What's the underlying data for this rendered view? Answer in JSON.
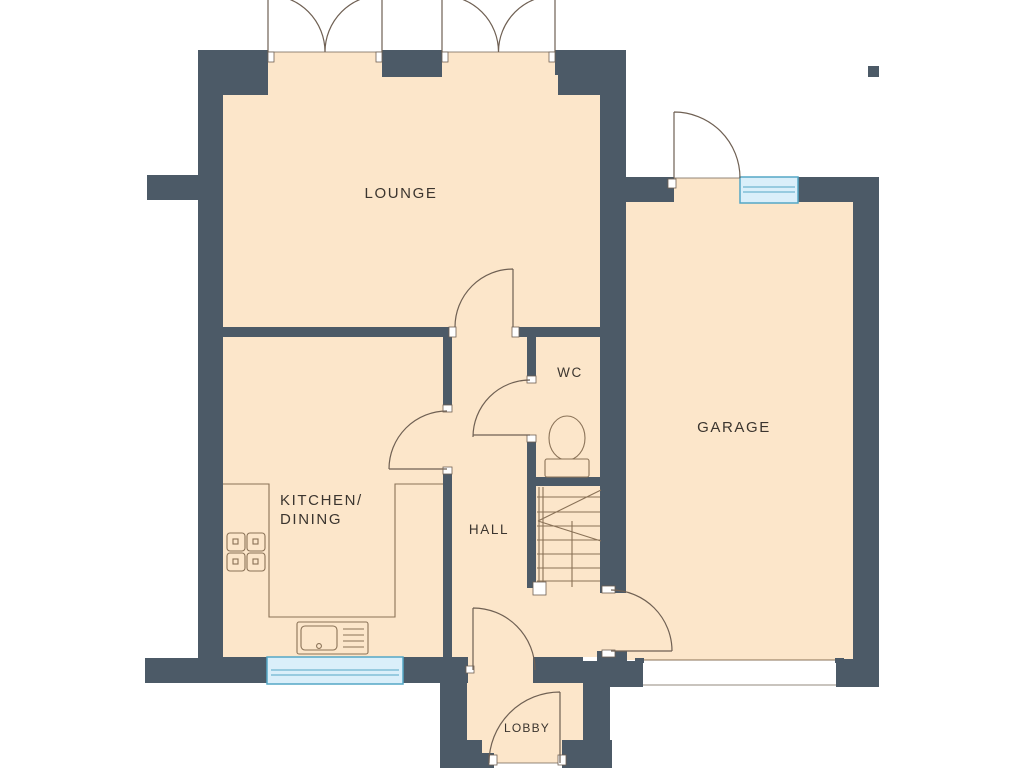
{
  "colors": {
    "wall": "#4c5a67",
    "floor": "#fce6ca",
    "window_fill": "#daeffa",
    "window_frame": "#54a7c6",
    "door_line": "#6f6053",
    "fixture_line": "#8a7257",
    "label_text": "#3b352f"
  },
  "rooms": {
    "lounge": {
      "label": "LOUNGE"
    },
    "garage": {
      "label": "GARAGE"
    },
    "wc": {
      "label": "WC"
    },
    "hall": {
      "label": "HALL"
    },
    "kitchen_dining": {
      "label_line1": "KITCHEN/",
      "label_line2": "DINING"
    },
    "lobby": {
      "label": "LOBBY"
    }
  }
}
